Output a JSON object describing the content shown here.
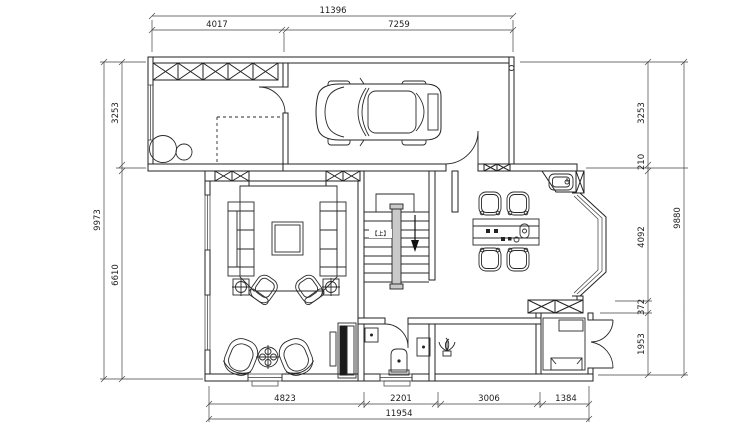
{
  "plan": {
    "stair": {
      "direction_label": "【上】"
    }
  },
  "dimensions": {
    "top": {
      "total": "11396",
      "segments": [
        "4017",
        "7259"
      ]
    },
    "bottom": {
      "total": "11954",
      "segments": [
        "4823",
        "2201",
        "3006",
        "1384"
      ]
    },
    "left": {
      "total": "9973",
      "segments": [
        "3253",
        "6610"
      ]
    },
    "right": {
      "total": "9880",
      "segments": [
        "3253",
        "210",
        "4092",
        "372",
        "1953"
      ]
    }
  },
  "icons": {
    "car": "car-top-view-icon",
    "toilet": "toilet-icon",
    "kitchen_sink": "kitchen-sink-icon",
    "bath_sink": "washbasin-icon",
    "plant": "plant-icon",
    "stair_arrow": "down-arrow-icon",
    "table_lamp": "lamp-cross-icon",
    "laundry_sinks": "double-basin-icon"
  },
  "colors": {
    "line": "#222222",
    "background": "#ffffff",
    "stair_rail_fill": "#c9c9c9",
    "cabinet_fill": "#1b1b1b"
  }
}
